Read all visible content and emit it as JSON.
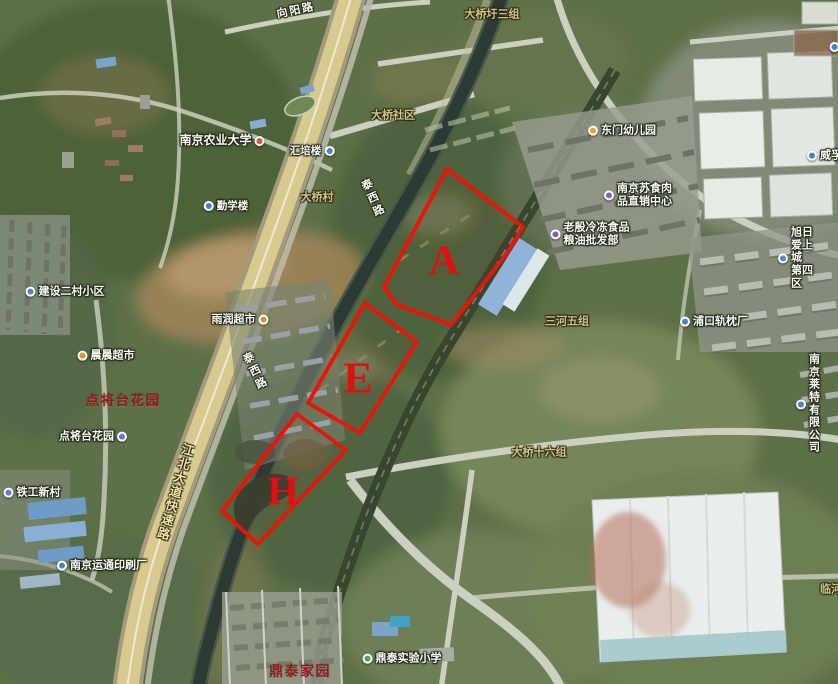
{
  "zone_style": {
    "stroke": "#ee1208",
    "letter_color": "#e01010"
  },
  "zones": [
    {
      "letter": "A",
      "points": "447,169 523,227 508,252 451,325 396,304 384,287",
      "lx": 444,
      "ly": 261,
      "fs": 42
    },
    {
      "letter": "E",
      "points": "365,303 417,342 360,433 308,403",
      "lx": 358,
      "ly": 378,
      "fs": 44
    },
    {
      "letter": "H",
      "points": "297,414 346,450 258,544 222,511",
      "lx": 283,
      "ly": 491,
      "fs": 40
    }
  ],
  "labels": [
    {
      "name": "xiangyang-road-label",
      "text": "向阳路",
      "type": "road-white",
      "x": 296,
      "y": 11,
      "rot": -12,
      "interactable": false
    },
    {
      "name": "daqiaowei-group3-label",
      "text": "大桥圩三组",
      "type": "village",
      "x": 492,
      "y": 15,
      "interactable": false
    },
    {
      "name": "daqiao-community-label",
      "text": "大桥社区",
      "type": "village",
      "x": 393,
      "y": 116,
      "interactable": false
    },
    {
      "name": "nanjing-agricultural-university-label",
      "text": "南京农业大学",
      "type": "poi",
      "size": 12,
      "x": 222,
      "y": 141,
      "icon": "#d9533c",
      "icon_side": "right",
      "icon_name": "university-poi-icon",
      "interactable": true
    },
    {
      "name": "huipei-building-label",
      "text": "汇培楼",
      "type": "poi",
      "size": 10.5,
      "x": 312,
      "y": 151,
      "icon": "#4a7fd1",
      "icon_side": "right",
      "icon_name": "building-poi-icon",
      "interactable": true
    },
    {
      "name": "qinxue-building-label",
      "text": "勤学楼",
      "type": "poi",
      "size": 10.5,
      "x": 226,
      "y": 206,
      "icon": "#4a7fd1",
      "icon_side": "left",
      "icon_name": "building-poi-icon",
      "interactable": true
    },
    {
      "name": "daqiao-village-label",
      "text": "大桥村",
      "type": "village",
      "x": 317,
      "y": 198,
      "interactable": false
    },
    {
      "name": "taixi-road-label-1",
      "text": "泰西路",
      "type": "road-white-v",
      "x": 372,
      "y": 199,
      "rot": -24,
      "interactable": false
    },
    {
      "name": "taixi-road-label-2",
      "text": "泰西路",
      "type": "road-white-v",
      "x": 254,
      "y": 372,
      "rot": -26,
      "interactable": false
    },
    {
      "name": "dongmen-kindergarten-label",
      "text": "东门幼儿园",
      "type": "poi",
      "x": 622,
      "y": 131,
      "icon": "#e8a33c",
      "icon_side": "left",
      "icon_name": "kindergarten-poi-icon",
      "interactable": true
    },
    {
      "name": "sushi-meat-center-label",
      "text": "南京苏食肉\n品直销中心",
      "type": "poi2",
      "x": 638,
      "y": 195,
      "icon": "#8a5ec0",
      "icon_side": "left",
      "icon_name": "shop-poi-icon",
      "interactable": true
    },
    {
      "name": "laoyin-frozen-food-label",
      "text": "老殷冷冻食品\n粮油批发部",
      "type": "poi2",
      "x": 590,
      "y": 234,
      "icon": "#8a5ec0",
      "icon_side": "left",
      "icon_name": "shop-poi-icon",
      "interactable": true
    },
    {
      "name": "weifu-label",
      "text": "威孚金",
      "type": "poi",
      "x": 830,
      "y": 156,
      "icon": "#4a7fd1",
      "icon_side": "left",
      "icon_name": "company-poi-icon",
      "interactable": true
    },
    {
      "name": "clipped-poi-label",
      "text": "",
      "type": "poi",
      "x": 836,
      "y": 47,
      "icon": "#4a7fd1",
      "icon_side": "left",
      "icon_name": "poi-icon",
      "interactable": true
    },
    {
      "name": "xuri-aishangcheng-district4-label",
      "text": "旭日爱上城\n第四区",
      "type": "poi2",
      "x": 798,
      "y": 258,
      "icon": "#5b7fd4",
      "icon_side": "left",
      "icon_name": "residence-poi-icon",
      "interactable": true
    },
    {
      "name": "sanhe-group5-label",
      "text": "三河五组",
      "type": "village",
      "x": 567,
      "y": 322,
      "interactable": false
    },
    {
      "name": "pukou-sleeper-factory-label",
      "text": "浦口轨枕厂",
      "type": "poi",
      "x": 714,
      "y": 322,
      "icon": "#4a7fd1",
      "icon_side": "left",
      "icon_name": "factory-poi-icon",
      "interactable": true
    },
    {
      "name": "nanjing-laite-company-label",
      "text": "南京莱特\n有限公司",
      "type": "poi2",
      "x": 810,
      "y": 404,
      "icon": "#4a7fd1",
      "icon_side": "left",
      "icon_name": "company-poi-icon",
      "interactable": true
    },
    {
      "name": "daqiao-group16-label",
      "text": "大桥十六组",
      "type": "village",
      "x": 539,
      "y": 453,
      "interactable": false
    },
    {
      "name": "jianshe-ercun-label",
      "text": "建设二村小区",
      "type": "poi",
      "x": 65,
      "y": 292,
      "icon": "#5b7fd4",
      "icon_side": "left",
      "icon_name": "residence-poi-icon",
      "interactable": true
    },
    {
      "name": "yurun-supermarket-label",
      "text": "雨润超市",
      "type": "poi",
      "x": 240,
      "y": 320,
      "icon": "#e2902e",
      "icon_side": "right",
      "icon_name": "supermarket-poi-icon",
      "interactable": true
    },
    {
      "name": "chenchen-supermarket-label",
      "text": "晨晨超市",
      "type": "poi",
      "x": 106,
      "y": 356,
      "icon": "#e2902e",
      "icon_side": "left",
      "icon_name": "supermarket-poi-icon",
      "interactable": true
    },
    {
      "name": "dianjiangtai-garden-area-label",
      "text": "点将台花园",
      "type": "estate",
      "x": 123,
      "y": 401,
      "interactable": false
    },
    {
      "name": "dianjiangtai-garden-poi-label",
      "text": "点将台花园",
      "type": "poi",
      "x": 93,
      "y": 437,
      "icon": "#5b7fd4",
      "icon_side": "right",
      "icon_name": "residence-poi-icon",
      "interactable": true
    },
    {
      "name": "tiegong-xincun-label",
      "text": "铁工新村",
      "type": "poi",
      "x": 32,
      "y": 493,
      "icon": "#5b7fd4",
      "icon_side": "left",
      "icon_name": "residence-poi-icon",
      "interactable": true
    },
    {
      "name": "yuntong-printing-label",
      "text": "南京运通印刷厂",
      "type": "poi",
      "x": 102,
      "y": 566,
      "icon": "#4a7fd1",
      "icon_side": "left",
      "icon_name": "factory-poi-icon",
      "interactable": true
    },
    {
      "name": "jiangbei-avenue-expressway-label",
      "text": "江北大道快速路",
      "type": "road-yellow-v",
      "x": 174,
      "y": 492,
      "rot": 16,
      "interactable": false
    },
    {
      "name": "dingtai-homeland-label",
      "text": "鼎泰家园",
      "type": "estate",
      "size": 14,
      "x": 300,
      "y": 671,
      "interactable": false
    },
    {
      "name": "dingtai-experimental-school-label",
      "text": "鼎泰实验小学",
      "type": "poi",
      "x": 402,
      "y": 659,
      "icon": "#4ea05c",
      "icon_side": "left",
      "icon_name": "school-poi-icon",
      "interactable": true
    },
    {
      "name": "linhe-label",
      "text": "临河",
      "type": "village",
      "x": 831,
      "y": 590,
      "interactable": false
    }
  ]
}
